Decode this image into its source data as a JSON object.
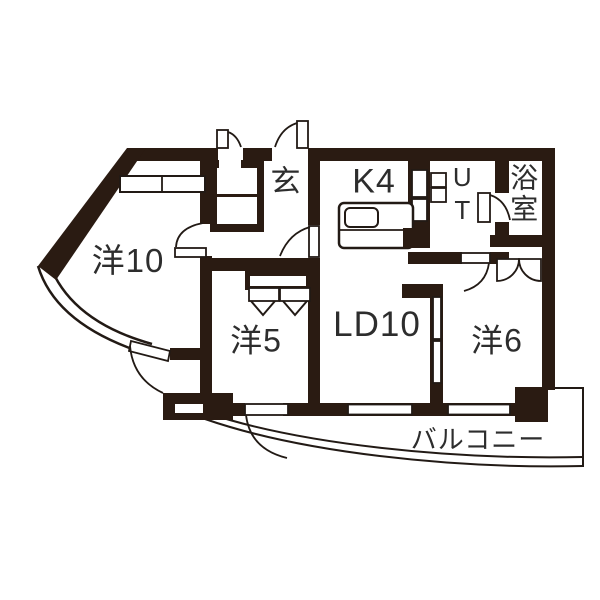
{
  "colors": {
    "wall": "#2a1b12",
    "line": "#221a15",
    "label": "#2d2d2d",
    "background": "#ffffff"
  },
  "rooms": [
    {
      "id": "yo10",
      "label": "洋10",
      "type": "western-room"
    },
    {
      "id": "genkan",
      "label": "玄",
      "type": "entrance"
    },
    {
      "id": "k4",
      "label": "K4",
      "type": "kitchen"
    },
    {
      "id": "ut",
      "label": "UT",
      "type": "utility",
      "orientation": "vertical"
    },
    {
      "id": "bath",
      "label": "浴室",
      "type": "bathroom",
      "orientation": "vertical"
    },
    {
      "id": "yo5",
      "label": "洋5",
      "type": "western-room"
    },
    {
      "id": "ld10",
      "label": "LD10",
      "type": "living-dining"
    },
    {
      "id": "yo6",
      "label": "洋6",
      "type": "western-room"
    },
    {
      "id": "balcony",
      "label": "バルコニー",
      "type": "balcony"
    }
  ]
}
